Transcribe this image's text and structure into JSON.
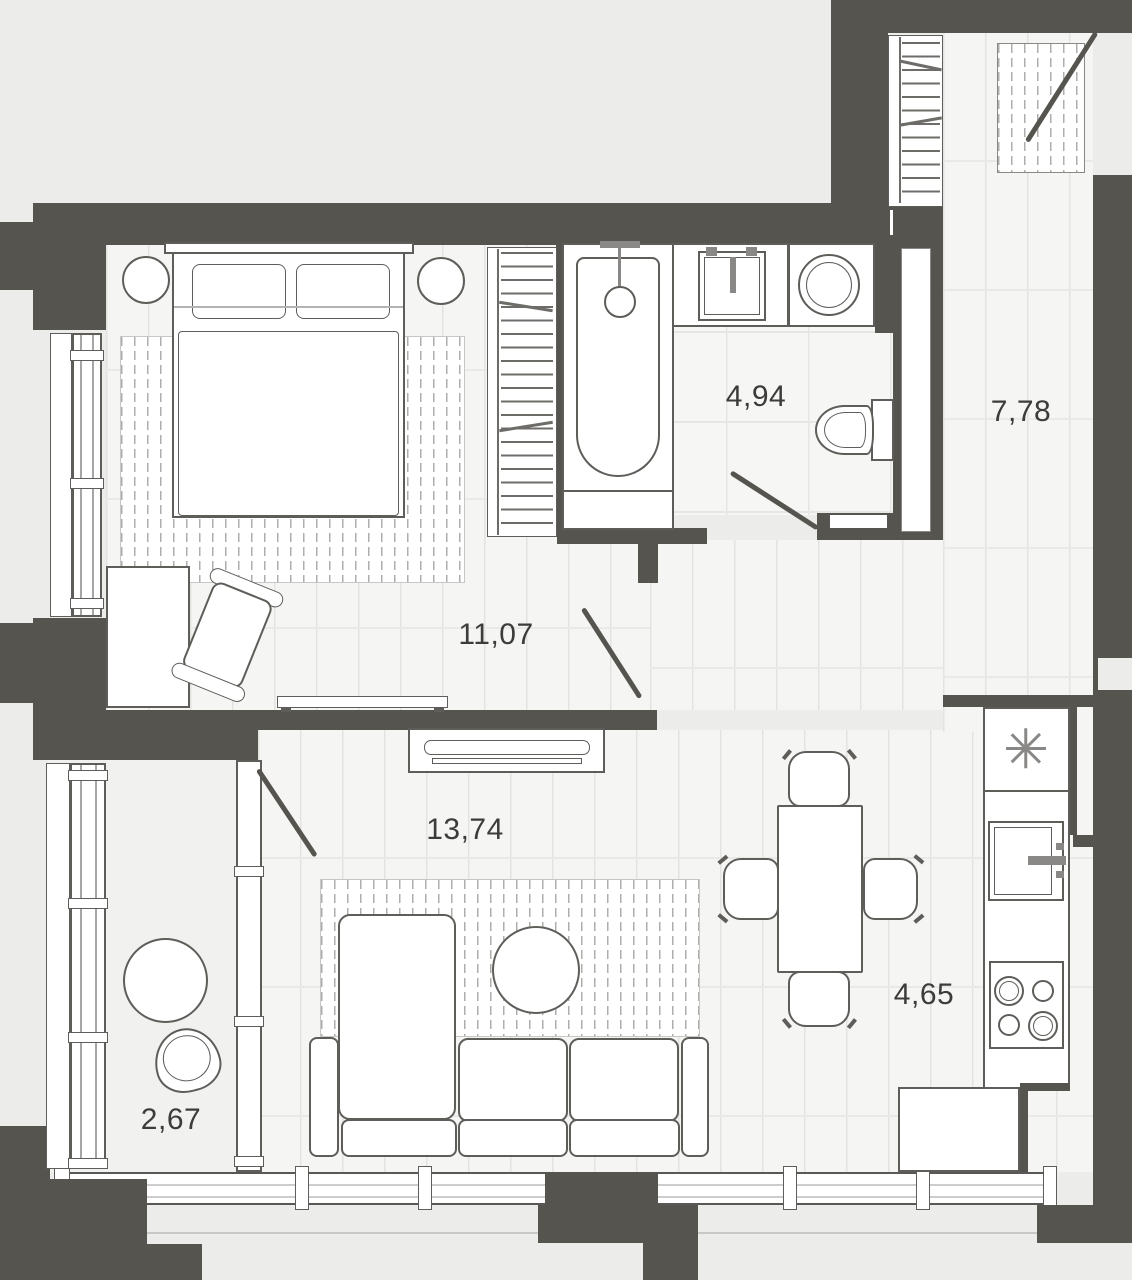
{
  "plan": {
    "title": "apartment-floor-plan",
    "rooms": [
      {
        "id": "bedroom",
        "area": "11,07"
      },
      {
        "id": "bathroom",
        "area": "4,94"
      },
      {
        "id": "hallway",
        "area": "7,78"
      },
      {
        "id": "living-room",
        "area": "13,74"
      },
      {
        "id": "kitchen",
        "area": "4,65"
      },
      {
        "id": "loggia",
        "area": "2,67"
      }
    ],
    "colors": {
      "wall": "#56544f",
      "floor": "#f5f5f3",
      "outside": "#ececea",
      "furniture_outline": "#5f5d59",
      "hatch": "#aeaeac",
      "label_text": "#3d3c3a"
    },
    "furniture_icons": [
      "double-bed",
      "nightstand",
      "wardrobe",
      "desk",
      "office-chair",
      "radiator-shelf",
      "tv-console",
      "corner-sofa",
      "coffee-table",
      "rug",
      "bathtub",
      "washbasin",
      "washing-machine",
      "toilet",
      "entry-closet",
      "doormat",
      "dining-table",
      "dining-chair",
      "kitchen-counter",
      "kitchen-sink",
      "cooktop",
      "fridge",
      "round-table",
      "armchair",
      "door-swing"
    ]
  }
}
